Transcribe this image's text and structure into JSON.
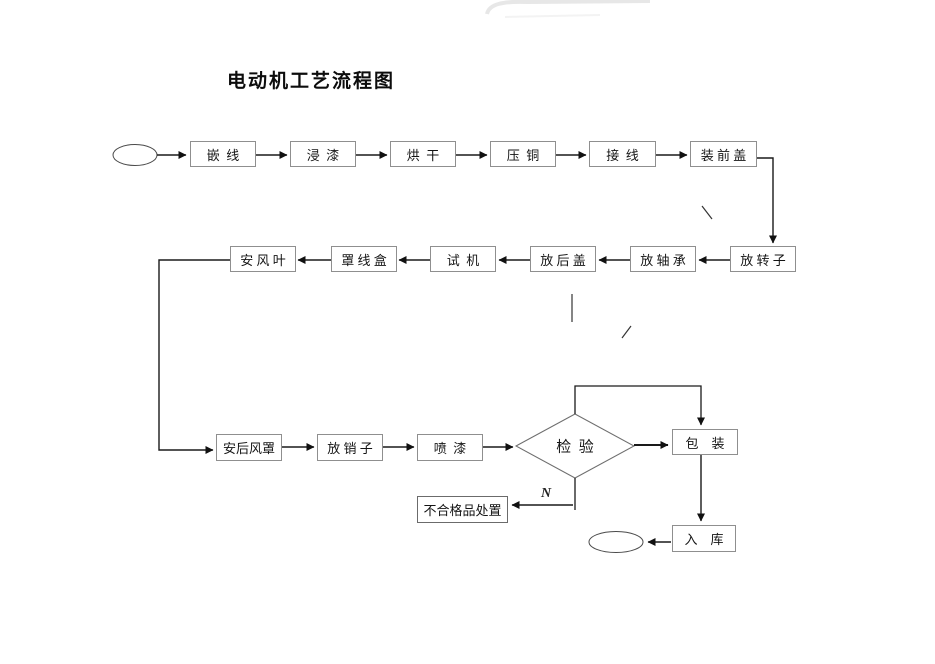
{
  "title": "电动机工艺流程图",
  "labels": {
    "no_branch": "N"
  },
  "nodes": {
    "start": {
      "shape": "ellipse",
      "label": ""
    },
    "qianxian": {
      "label": "嵌  线"
    },
    "jinqi": {
      "label": "浸  漆"
    },
    "honggan": {
      "label": "烘  干"
    },
    "yatong": {
      "label": "压  铜"
    },
    "jiexian": {
      "label": "接  线"
    },
    "zhuangqiangai": {
      "label": "装 前 盖"
    },
    "fangzhuanzi": {
      "label": "放 转 子"
    },
    "fangzhoucheng": {
      "label": "放 轴 承"
    },
    "fanghougai": {
      "label": "放 后 盖"
    },
    "shiji": {
      "label": "试  机"
    },
    "zhaoxianhe": {
      "label": "罩 线 盒"
    },
    "anfengye": {
      "label": "安 风 叶"
    },
    "anhoufengzhao": {
      "label": "安后风罩"
    },
    "fangxiaozi": {
      "label": "放 销 子"
    },
    "penqi": {
      "label": "喷  漆"
    },
    "jianyan": {
      "label": "检  验"
    },
    "baozhuang": {
      "label": "包    装"
    },
    "buhegepin": {
      "label": "不合格品处置"
    },
    "ruku": {
      "label": "入    库"
    },
    "end": {
      "shape": "ellipse",
      "label": ""
    }
  },
  "colors": {
    "line": "#1a1a1a",
    "box_border": "#8f8f8f",
    "artifact": "#e7e7e7"
  }
}
